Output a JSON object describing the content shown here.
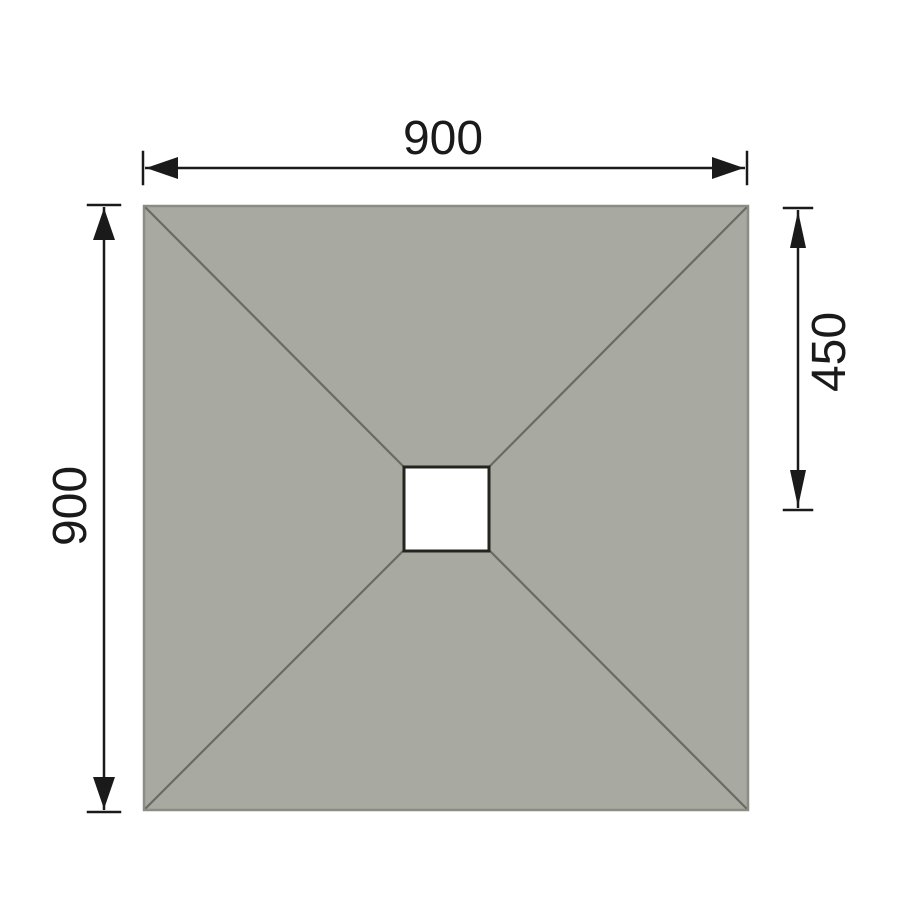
{
  "diagram": {
    "kind": "dimension-drawing",
    "labels": {
      "width_top": "900",
      "height_left": "900",
      "drain_offset_right": "450"
    },
    "colors": {
      "background": "#ffffff",
      "tray_fill": "#a8a9a0",
      "tray_border": "#8b8d85",
      "slope_line": "#696b64",
      "drain_fill": "#ffffff",
      "drain_border": "#25251f",
      "dimension_ink": "#1a1a1a"
    }
  }
}
